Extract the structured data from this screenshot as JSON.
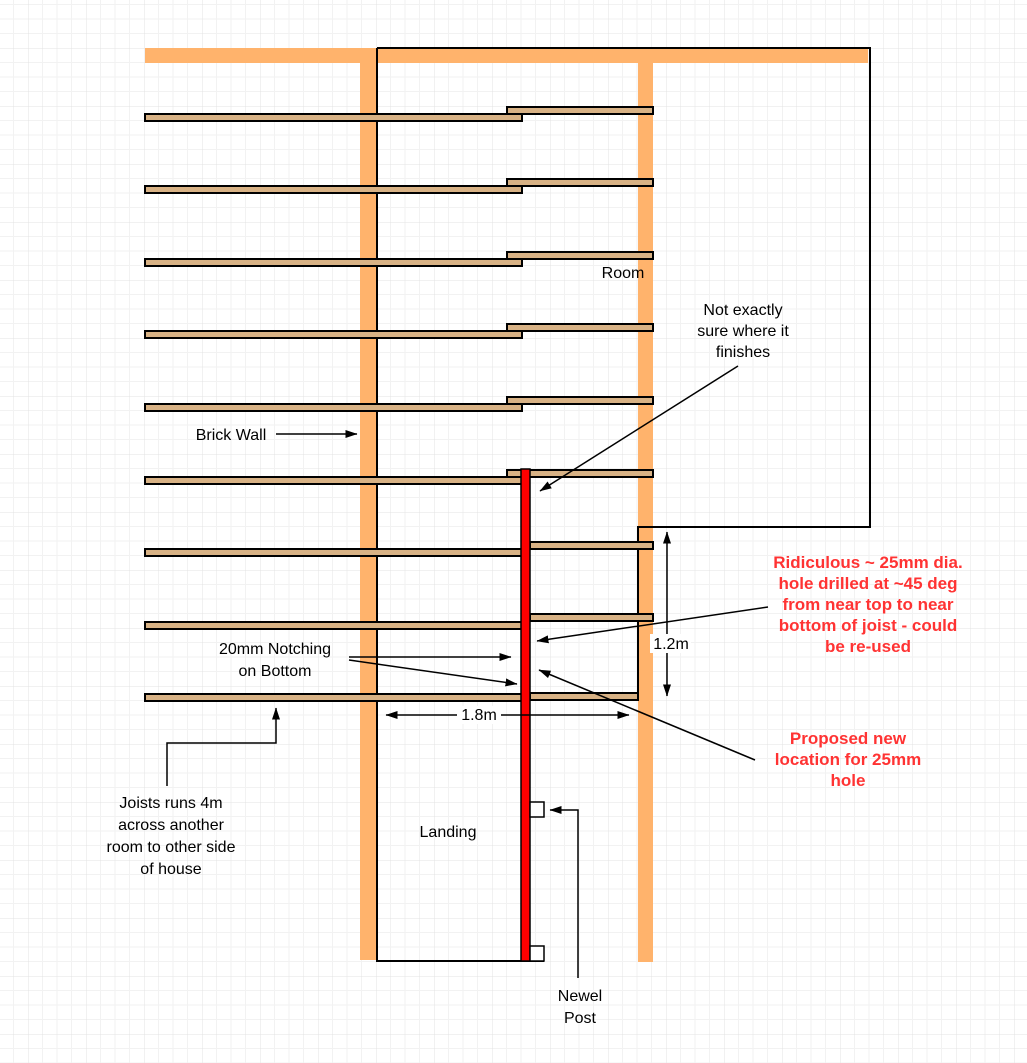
{
  "diagram": {
    "labels": {
      "room": "Room",
      "brick_wall": "Brick Wall",
      "landing": "Landing",
      "dim_vertical": "1.2m",
      "dim_horizontal": "1.8m",
      "not_exactly": {
        "lines": [
          "Not exactly",
          "sure where it",
          "finishes"
        ]
      },
      "notching": {
        "lines": [
          "20mm Notching",
          "on Bottom"
        ]
      },
      "joists_runs": {
        "lines": [
          "Joists runs 4m",
          "across another",
          "room to other side",
          "of house"
        ]
      },
      "newel_post": {
        "lines": [
          "Newel",
          "Post"
        ]
      }
    },
    "annotations_red": {
      "ridiculous": {
        "lines": [
          "Ridiculous ~ 25mm dia.",
          "hole drilled at ~45 deg",
          "from near top to near",
          "bottom of joist - could",
          "be re-used"
        ]
      },
      "proposed": {
        "lines": [
          "Proposed new",
          "location for 25mm",
          "hole"
        ]
      }
    },
    "colors": {
      "wall": "#FFB36C",
      "joist": "#D8B285",
      "trimmer": "#FF0000",
      "red_text": "#FF3333",
      "line": "#000000",
      "text": "#000000",
      "grid_minor": "#F2F2F2",
      "grid_major": "#E3E3E3"
    }
  }
}
